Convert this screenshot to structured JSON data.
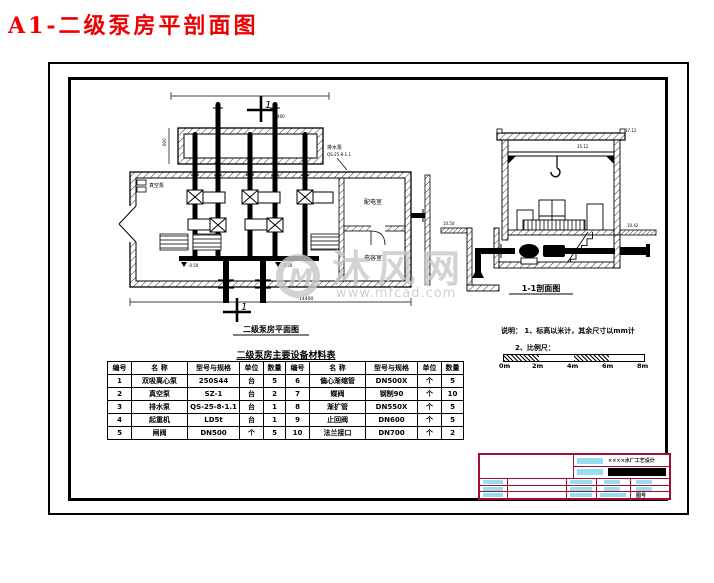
{
  "page": {
    "title": "A1-二级泵房平剖面图"
  },
  "plan": {
    "caption": "二级泵房平面图",
    "section_marker": "1",
    "labels": {
      "vacuum_pump": "真空泵",
      "drain_pump": "排水泵",
      "drain_pump_model": "QS-25-8-1.1",
      "room_upper": "配电室",
      "room_lower": "电容室"
    },
    "dims": {
      "top": "14400",
      "channel_width": "600",
      "overall": "14400",
      "floor_elev_left": "-0.50",
      "floor_elev_right": "-0.50"
    }
  },
  "section": {
    "caption": "1-1剖面图",
    "elevations": {
      "roof": "37.12",
      "crane_beam": "35.12",
      "ground_left": "10.50",
      "ground_right": "10.42"
    }
  },
  "notes": {
    "line1": "说明： 1、标高以米计，其余尺寸以mm计",
    "line2": "2、比例尺：",
    "scale_ticks": [
      "0m",
      "2m",
      "4m",
      "6m",
      "8m"
    ]
  },
  "materials_table": {
    "title": "二级泵房主要设备材料表",
    "headers": [
      "编号",
      "名 称",
      "型号与规格",
      "单位",
      "数量",
      "编号",
      "名 称",
      "型号与规格",
      "单位",
      "数量"
    ],
    "rows": [
      [
        "1",
        "双吸离心泵",
        "250S44",
        "台",
        "5",
        "6",
        "偏心渐缩管",
        "DN500X",
        "个",
        "5"
      ],
      [
        "2",
        "真空泵",
        "SZ-1",
        "台",
        "2",
        "7",
        "蝶阀",
        "钢制90",
        "个",
        "10"
      ],
      [
        "3",
        "排水泵",
        "QS-25-8-1.1",
        "台",
        "1",
        "8",
        "渐扩管",
        "DN550X",
        "个",
        "5"
      ],
      [
        "4",
        "起重机",
        "LD5t",
        "台",
        "1",
        "9",
        "止回阀",
        "DN600",
        "个",
        "5"
      ],
      [
        "5",
        "闸阀",
        "DN500",
        "个",
        "5",
        "10",
        "法兰接口",
        "DN700",
        "个",
        "2"
      ]
    ]
  },
  "title_block": {
    "project": "××××水厂工艺设计",
    "drawing_no_label": "图号"
  },
  "watermark": {
    "logo_letter": "M",
    "site_name": "沐风网",
    "site_url": "www.mfcad.com"
  },
  "colors": {
    "title_red": "#ee0000",
    "block_maroon": "#a00f2f",
    "chip_cyan": "#96dff2",
    "watermark_gray": "#c7c7c7"
  }
}
